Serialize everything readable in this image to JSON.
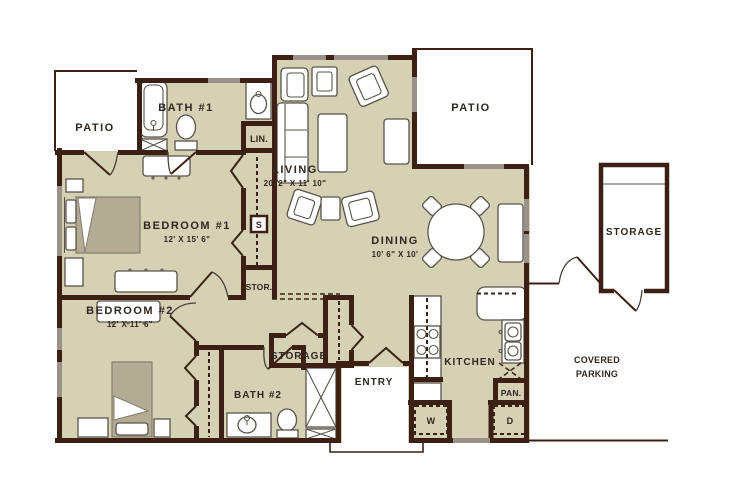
{
  "plan": {
    "rooms": {
      "patio_left": {
        "label": "PATIO"
      },
      "bath1": {
        "label": "BATH #1"
      },
      "lin": {
        "label": "LIN."
      },
      "living": {
        "label": "LIVING",
        "dims": "20' 2\" X 11' 10\""
      },
      "patio_right": {
        "label": "PATIO"
      },
      "bedroom1": {
        "label": "BEDROOM #1",
        "dims": "12' X 15' 6\""
      },
      "dining": {
        "label": "DINING",
        "dims": "10' 6\" X 10'"
      },
      "storage_ext": {
        "label": "STORAGE"
      },
      "stor_closet": {
        "label": "STOR."
      },
      "shelf": {
        "label": "S"
      },
      "bedroom2": {
        "label": "BEDROOM #2",
        "dims": "12' X 11' 6\""
      },
      "storage_mid": {
        "label": "STORAGE"
      },
      "bath2": {
        "label": "BATH #2"
      },
      "entry": {
        "label": "ENTRY"
      },
      "kitchen": {
        "label": "KITCHEN"
      },
      "pantry": {
        "label": "PAN."
      },
      "washer": {
        "label": "W"
      },
      "dryer": {
        "label": "D"
      },
      "covered_parking_line1": "COVERED",
      "covered_parking_line2": "PARKING"
    },
    "colors": {
      "floor": "#d5d1b4",
      "wall": "#3d2014",
      "window": "#9a9189",
      "text": "#2f2721"
    }
  }
}
